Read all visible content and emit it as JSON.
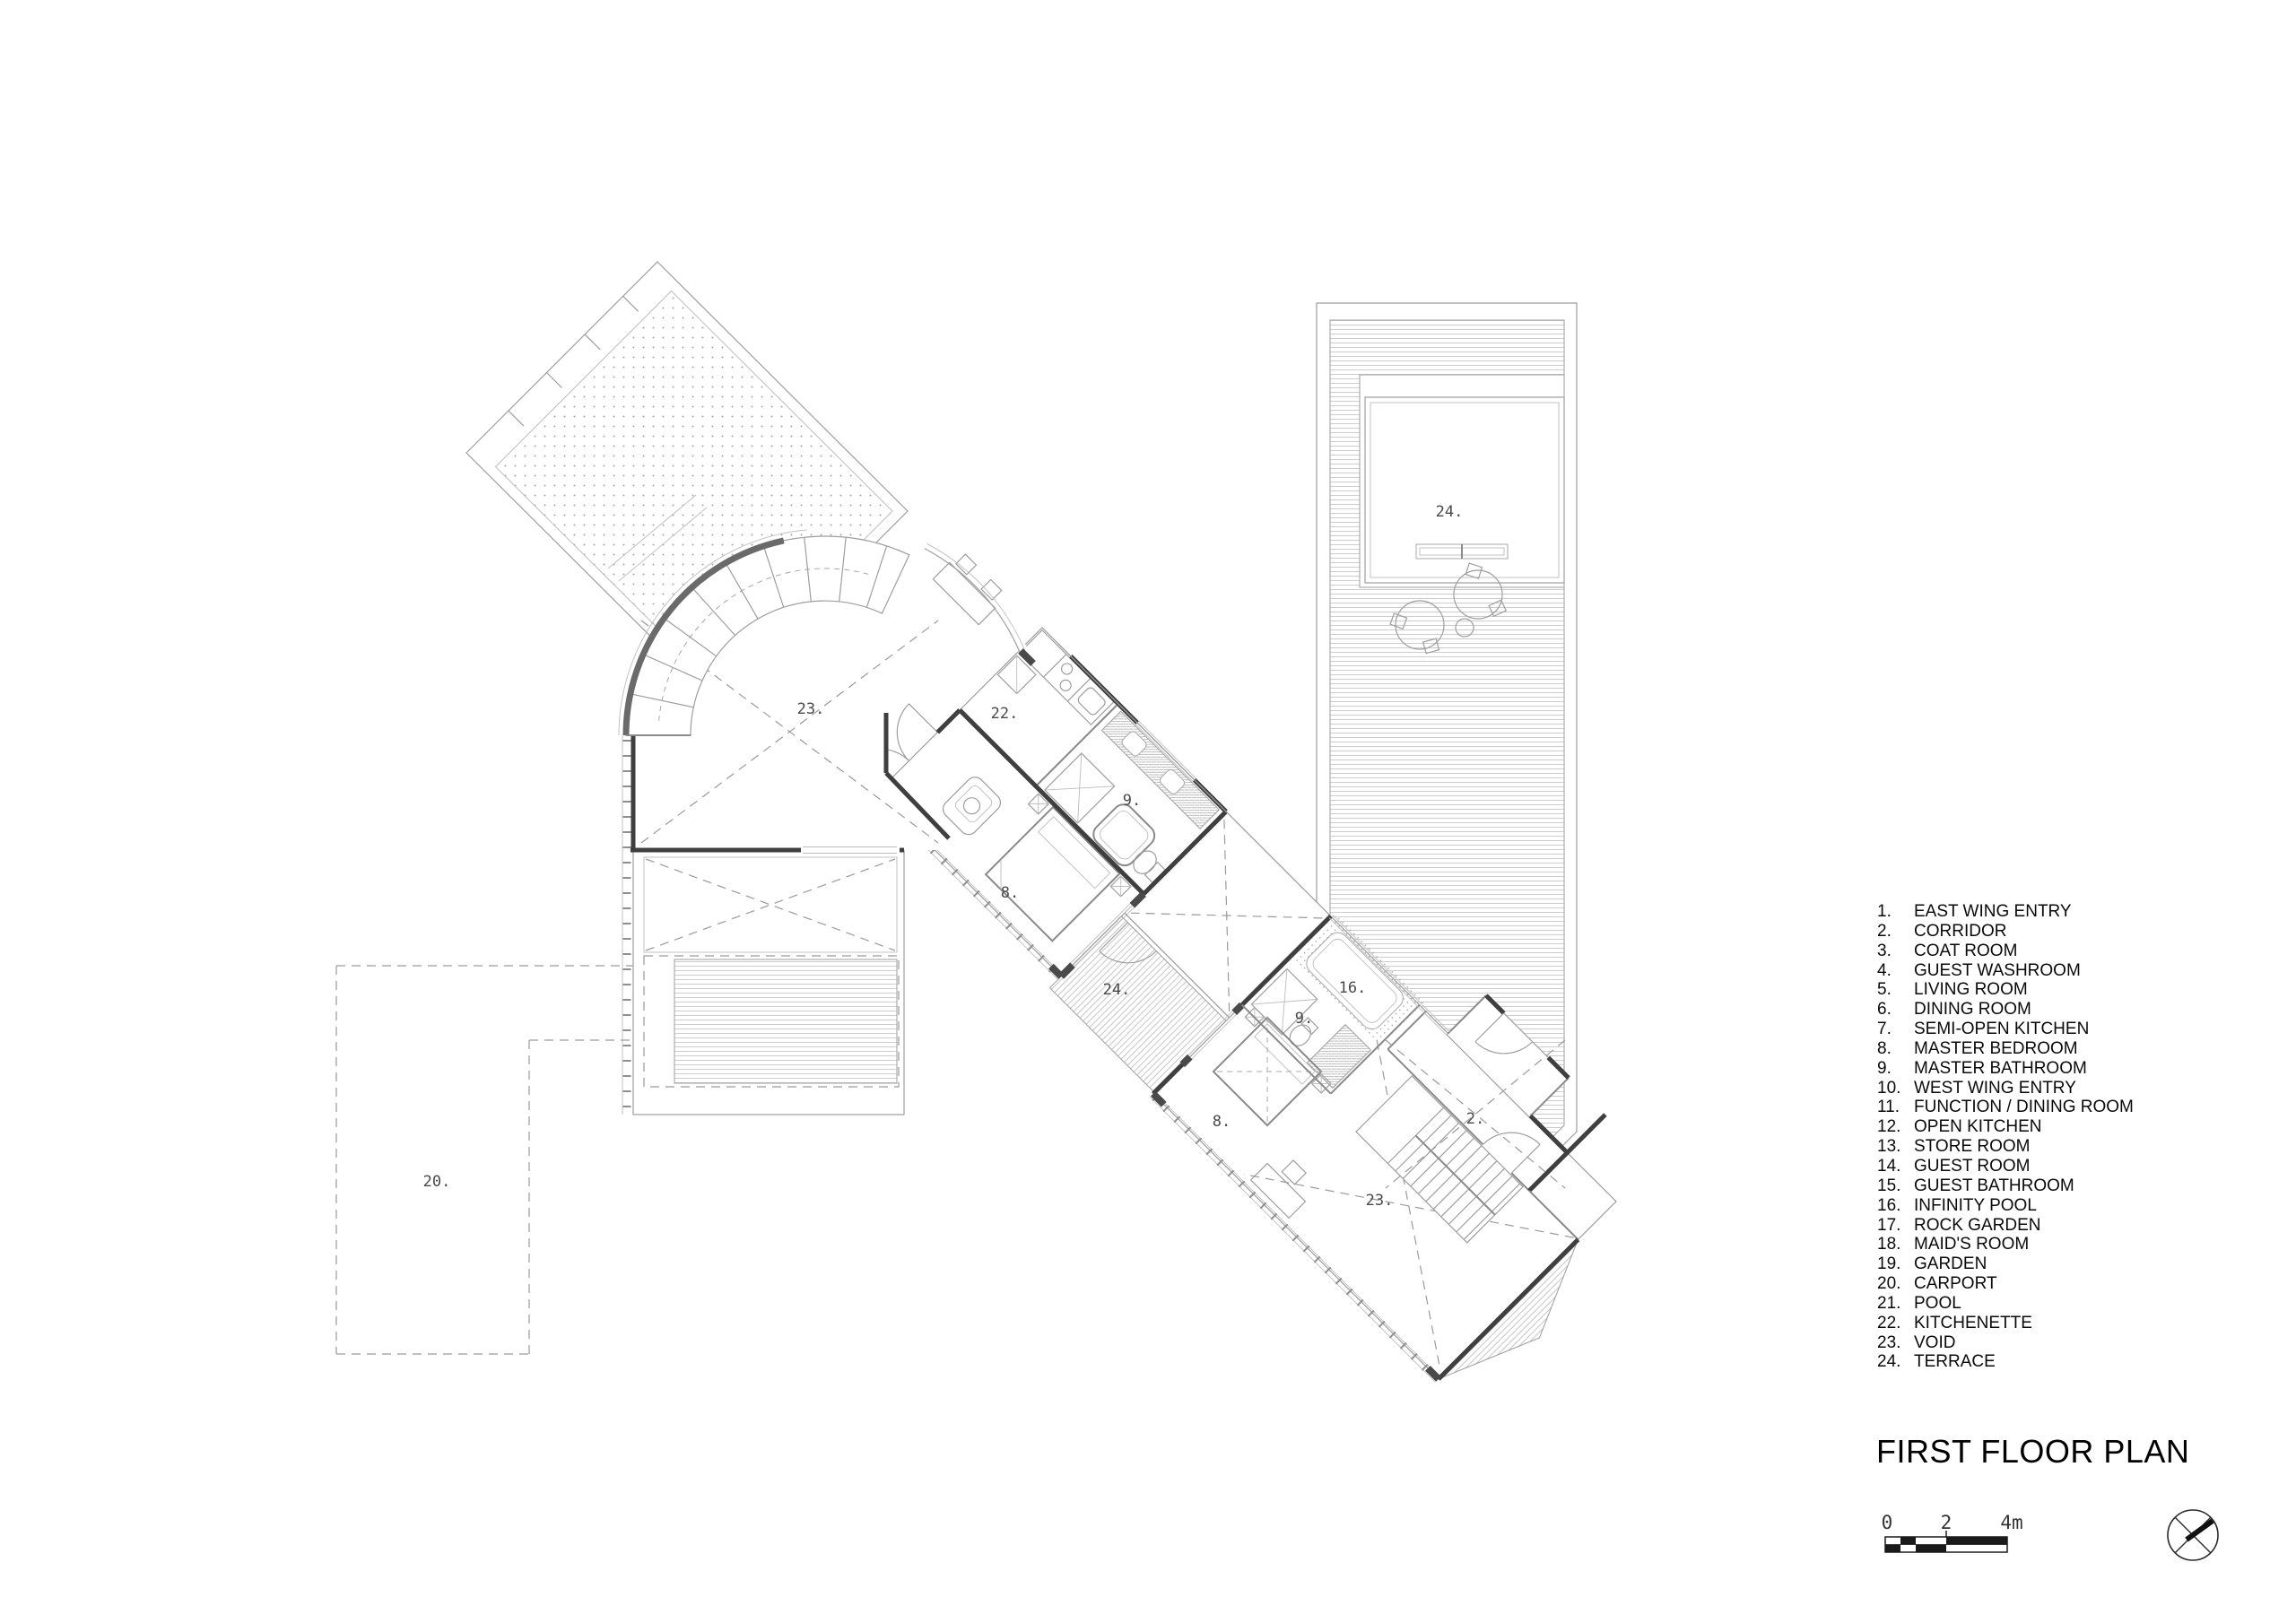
{
  "header": {
    "title": "FIRST FLOOR PLAN"
  },
  "legend": {
    "items": [
      {
        "num": "1.",
        "label": "EAST WING ENTRY"
      },
      {
        "num": "2.",
        "label": "CORRIDOR"
      },
      {
        "num": "3.",
        "label": "COAT ROOM"
      },
      {
        "num": "4.",
        "label": "GUEST WASHROOM"
      },
      {
        "num": "5.",
        "label": "LIVING ROOM"
      },
      {
        "num": "6.",
        "label": "DINING ROOM"
      },
      {
        "num": "7.",
        "label": "SEMI-OPEN KITCHEN"
      },
      {
        "num": "8.",
        "label": "MASTER BEDROOM"
      },
      {
        "num": "9.",
        "label": "MASTER BATHROOM"
      },
      {
        "num": "10.",
        "label": "WEST WING ENTRY"
      },
      {
        "num": "11.",
        "label": "FUNCTION / DINING ROOM"
      },
      {
        "num": "12.",
        "label": "OPEN KITCHEN"
      },
      {
        "num": "13.",
        "label": "STORE ROOM"
      },
      {
        "num": "14.",
        "label": "GUEST ROOM"
      },
      {
        "num": "15.",
        "label": "GUEST BATHROOM"
      },
      {
        "num": "16.",
        "label": "INFINITY POOL"
      },
      {
        "num": "17.",
        "label": "ROCK GARDEN"
      },
      {
        "num": "18.",
        "label": "MAID'S ROOM"
      },
      {
        "num": "19.",
        "label": "GARDEN"
      },
      {
        "num": "20.",
        "label": "CARPORT"
      },
      {
        "num": "21.",
        "label": "POOL"
      },
      {
        "num": "22.",
        "label": "KITCHENETTE"
      },
      {
        "num": "23.",
        "label": "VOID"
      },
      {
        "num": "24.",
        "label": "TERRACE"
      }
    ]
  },
  "plan": {
    "labels": {
      "void_upper": "23.",
      "kitchenette": "22.",
      "master_bathroom_upper": "9.",
      "master_bedroom_upper": "8.",
      "terrace_central": "24.",
      "terrace_right": "24.",
      "master_bedroom_lower": "8.",
      "master_bathroom_lower": "9.",
      "infinity_pool": "16.",
      "corridor": "2.",
      "void_lower": "23.",
      "carport": "20."
    }
  },
  "scale_bar": {
    "tick0": "0",
    "tick2": "2",
    "tick4": "4m"
  },
  "colors": {
    "background": "#ffffff",
    "wall_dark": "#3f3f3f",
    "line_mid": "#8a8a8a",
    "hatch": "#cfcfcf"
  }
}
